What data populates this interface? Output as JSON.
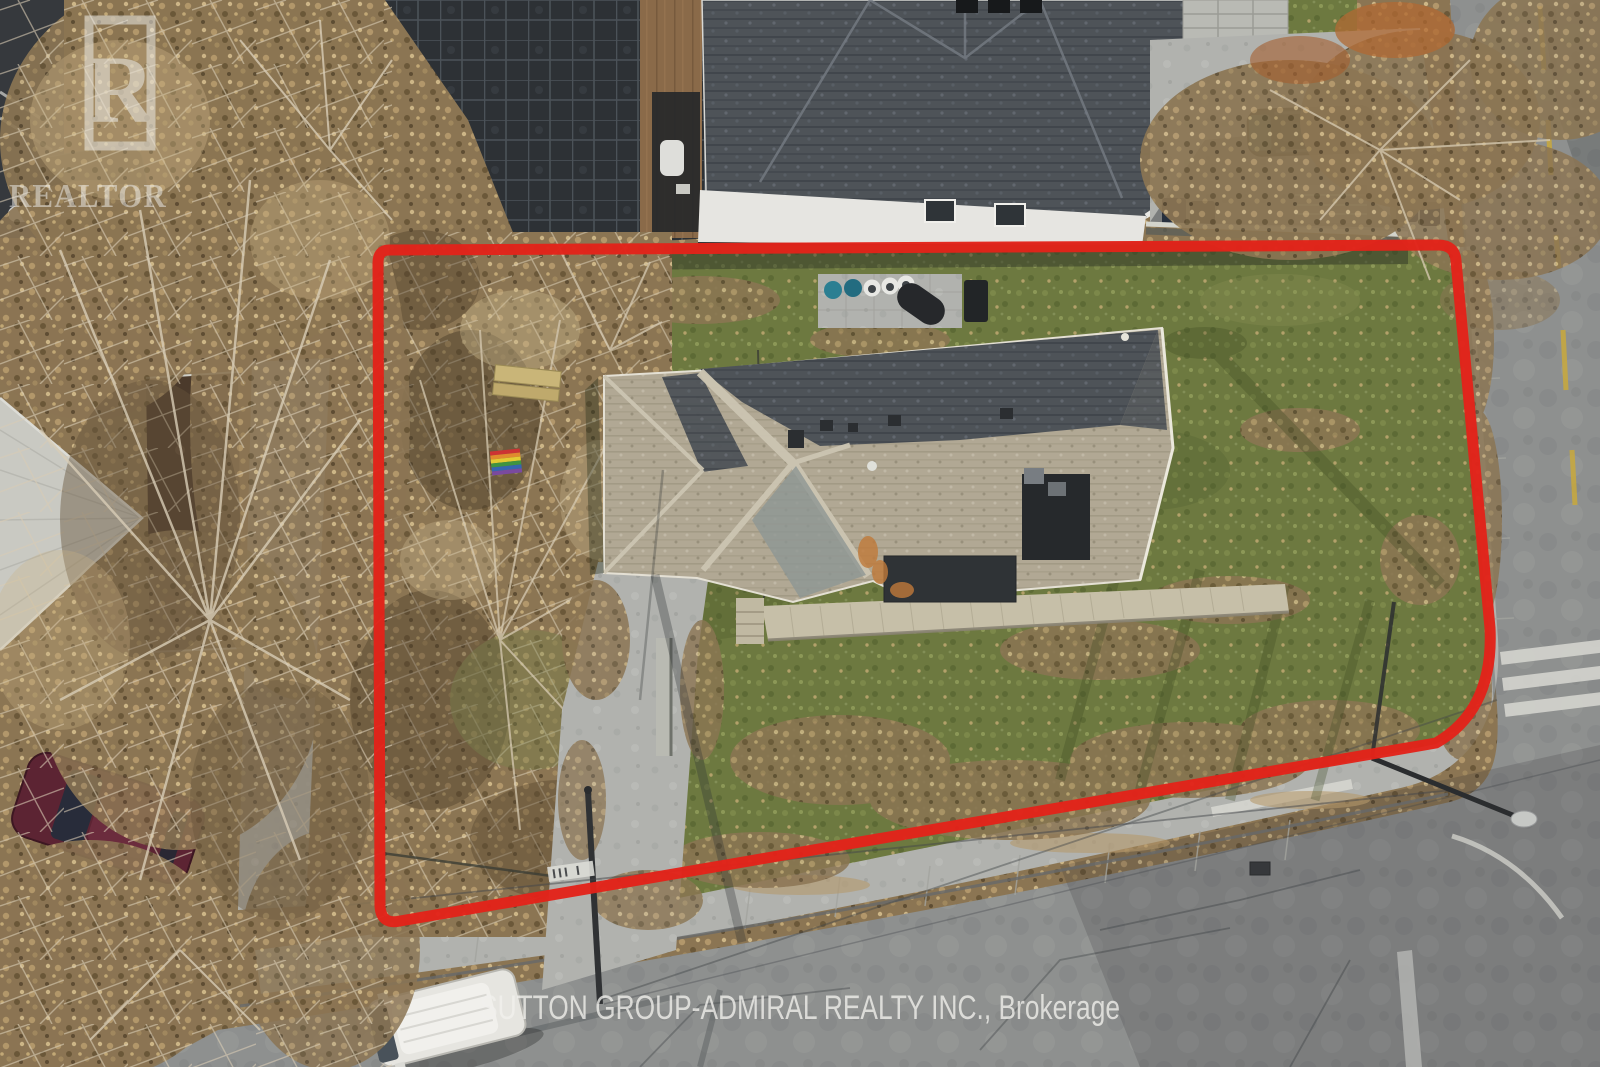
{
  "watermarks": {
    "realtor_logo": {
      "letter": "R",
      "label": "REALTOR"
    },
    "brokerage_label": "SUTTON GROUP-ADMIRAL REALTY INC., Brokerage"
  },
  "colors": {
    "property_boundary": "#e2231a",
    "watermark_text": "#f2f1ee"
  }
}
